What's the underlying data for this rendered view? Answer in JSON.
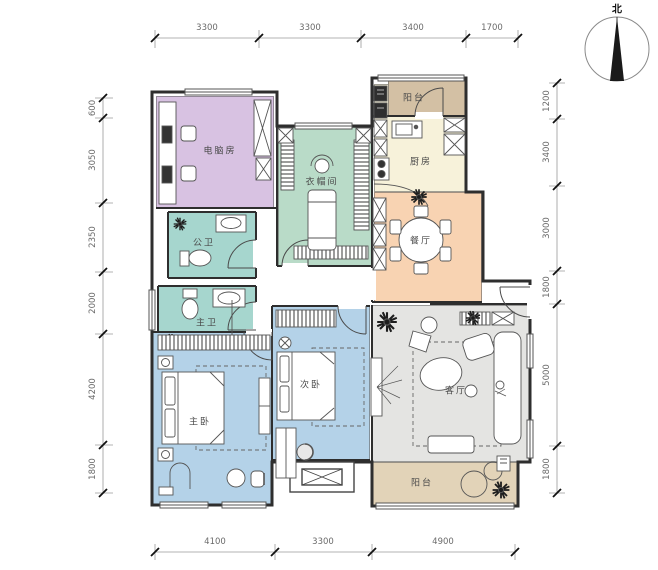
{
  "north_label": "北",
  "dimensions": {
    "top": [
      "3300",
      "3300",
      "3400",
      "1700"
    ],
    "bottom": [
      "4100",
      "3300",
      "4900"
    ],
    "left": [
      "600",
      "3050",
      "2350",
      "2000",
      "4200",
      "1800"
    ],
    "right": [
      "1200",
      "3400",
      "3000",
      "1800",
      "5000",
      "1800"
    ]
  },
  "rooms": {
    "computer_room": {
      "label": "电脑房",
      "color": "#d8c2e2"
    },
    "cloakroom": {
      "label": "衣帽间",
      "color": "#b9dbc8"
    },
    "balcony_top": {
      "label": "阳台",
      "color": "#d3c0a4"
    },
    "kitchen": {
      "label": "厨房",
      "color": "#f7f2da"
    },
    "dining": {
      "label": "餐厅",
      "color": "#f8d3b2"
    },
    "bath_public": {
      "label": "公卫",
      "color": "#a6d6ce"
    },
    "bath_master": {
      "label": "主卫",
      "color": "#a6d6ce"
    },
    "master_bedroom": {
      "label": "主卧",
      "color": "#b4d2e8"
    },
    "second_bedroom": {
      "label": "次卧",
      "color": "#b4d2e8"
    },
    "living_room": {
      "label": "客厅",
      "color": "#e4e4e2"
    },
    "balcony_bottom": {
      "label": "阳台",
      "color": "#e2d3b8"
    }
  },
  "colors": {
    "wall": "#2e2e2e",
    "furniture_line": "#555555"
  }
}
